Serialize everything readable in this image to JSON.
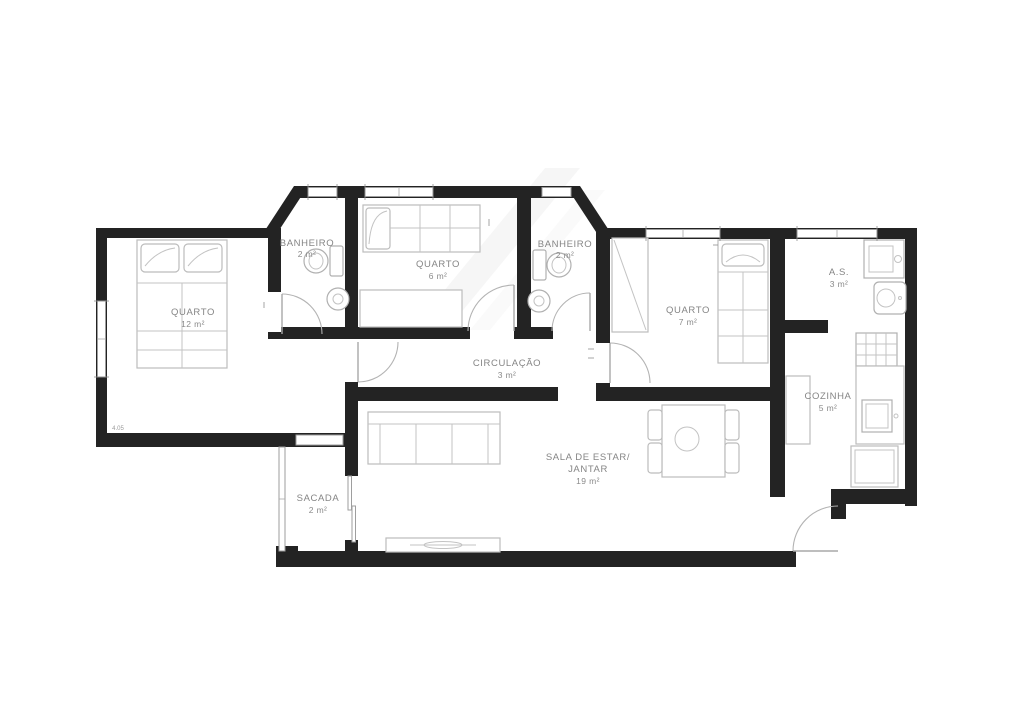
{
  "document": {
    "type": "apartment-floor-plan"
  },
  "rooms": [
    {
      "id": "quarto-casal",
      "name": "QUARTO",
      "area": "12 m²"
    },
    {
      "id": "banheiro-1",
      "name": "BANHEIRO",
      "area": "2 m²"
    },
    {
      "id": "quarto-6",
      "name": "QUARTO",
      "area": "6 m²"
    },
    {
      "id": "banheiro-2",
      "name": "BANHEIRO",
      "area": "2 m²"
    },
    {
      "id": "quarto-7",
      "name": "QUARTO",
      "area": "7 m²"
    },
    {
      "id": "area-servico",
      "name": "A.S.",
      "area": "3 m²"
    },
    {
      "id": "cozinha",
      "name": "COZINHA",
      "area": "5 m²"
    },
    {
      "id": "circulacao",
      "name": "CIRCULAÇÃO",
      "area": "3 m²"
    },
    {
      "id": "sala",
      "name": "SALA DE ESTAR/",
      "name_line2": "JANTAR",
      "area": "19 m²"
    },
    {
      "id": "sacada",
      "name": "SACADA",
      "area": "2 m²"
    }
  ],
  "dimensions": [
    {
      "label": "4.05"
    }
  ],
  "colors": {
    "wall": "#232323",
    "furniture_stroke": "#bcbcbc",
    "label": "#858585",
    "window_frame": "#9e9e9e"
  }
}
